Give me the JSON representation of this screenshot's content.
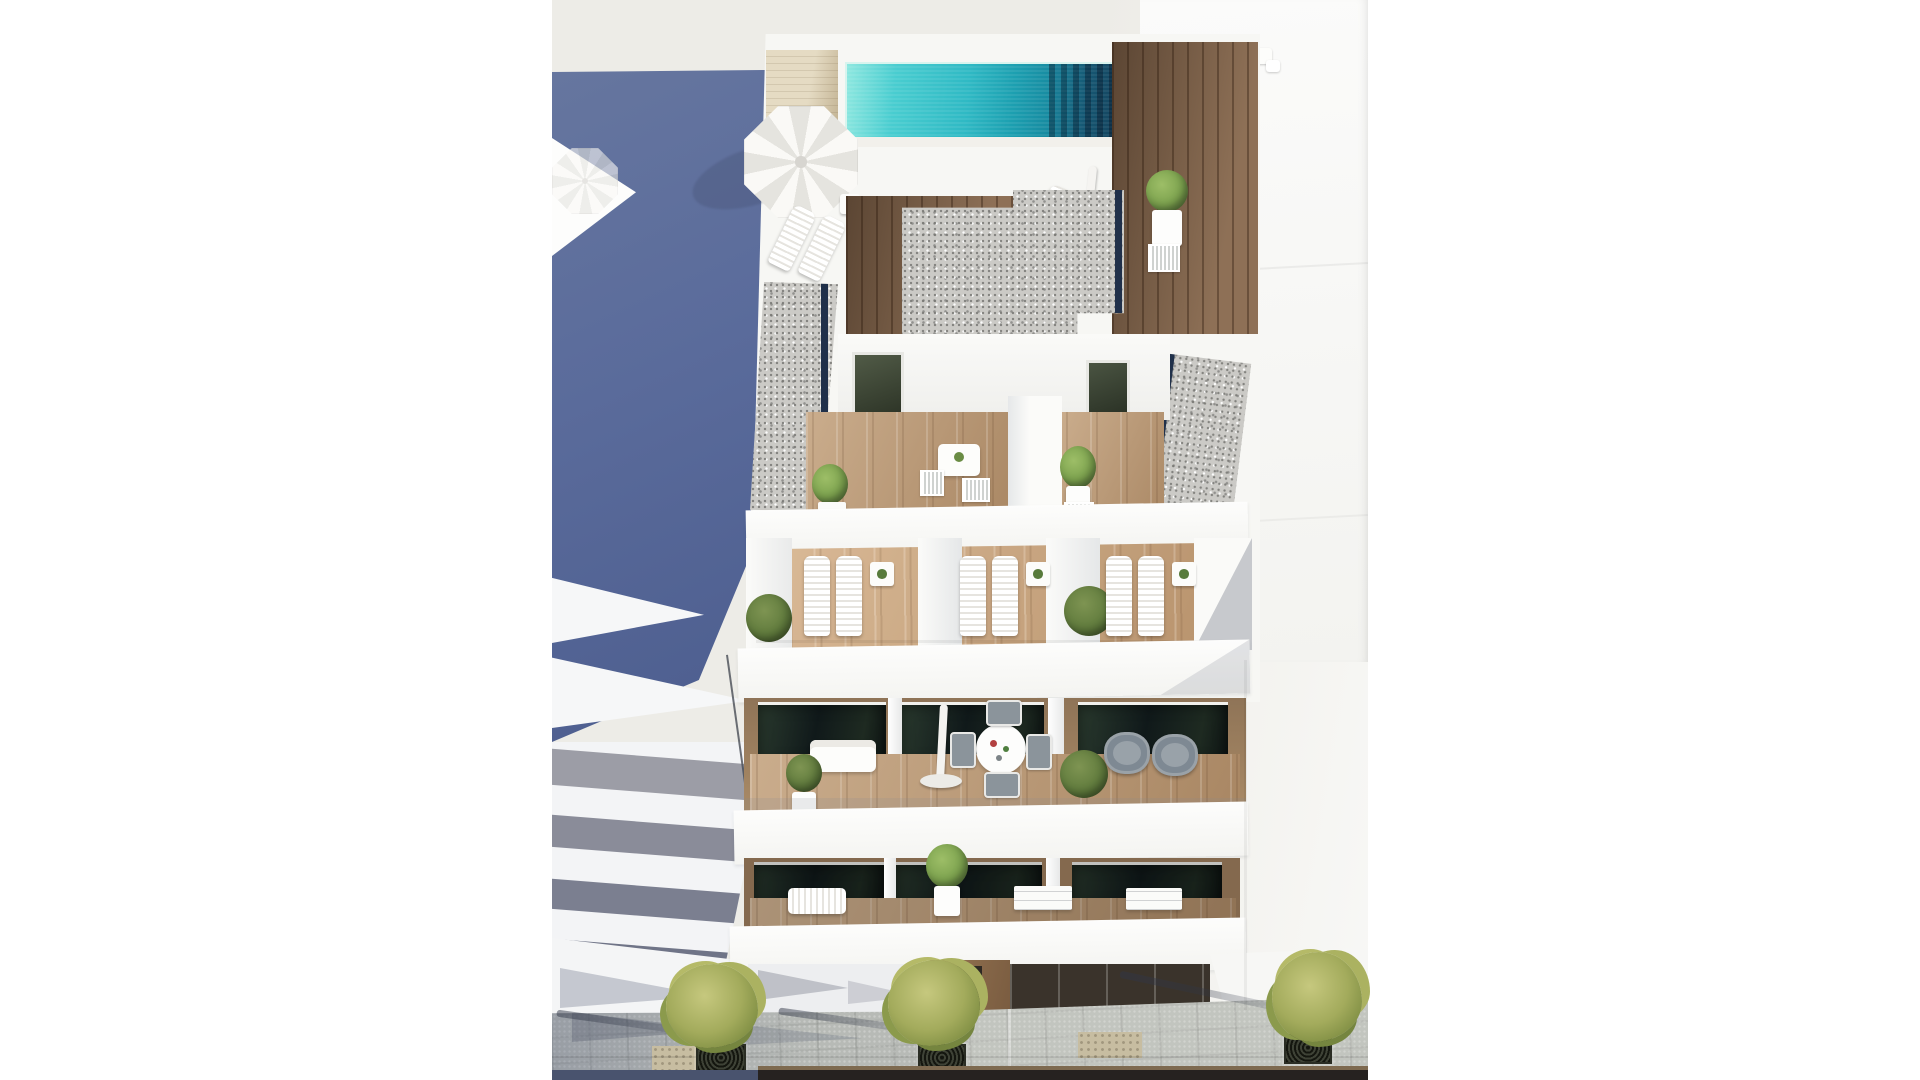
{
  "image": {
    "width": 1920,
    "height": 1080
  },
  "scene": {
    "type": "architectural_aerial_render",
    "subject": "Aerial 3D render of a modern white apartment building with rooftop pool, terraces, balconies and street below",
    "features": [
      "rooftop pool with mosaic water",
      "sun deck with open parasol and loungers",
      "gravel flat roofs with glass edges",
      "private terraces with sun loungers and plants",
      "stacked balconies with dining set, armchairs and closed parasol",
      "neighboring white building in shadow",
      "paved sidewalk with street trees"
    ]
  },
  "palette": {
    "backdrop": "#EDECE7",
    "backdrop_right": "#F8F8F6",
    "shadow_blue": "#5A6B9B",
    "shadow_blue_deep": "#4C5D8E",
    "neighbor_band_light": "#9C9DA6",
    "neighbor_band_mid": "#8A8C99",
    "neighbor_band_dark": "#7B7F90",
    "white_wall": "#FBFBFA",
    "pool_aqua_light": "#8FE8E0",
    "pool_aqua": "#2FB9C4",
    "pool_deep": "#123F58",
    "wood_walnut": "#7E6047",
    "wood_oak": "#B6936E",
    "wood_beige": "#DCCFAF",
    "gravel": "#CBCAC6",
    "glass_dark": "#1C241E",
    "navy_edge": "#20304A",
    "plant_green": "#7CA24E",
    "plant_olive": "#5F7A3C",
    "street_tree": "#A3AB5C",
    "pavement": "#B7BAB6",
    "asphalt_blue": "#49536E",
    "asphalt_dark": "#262220",
    "curb_tan": "#7E6A50",
    "chair_gray": "#8B949B"
  },
  "building": {
    "lounger_bays": [
      {
        "x": 804
      },
      {
        "x": 960
      },
      {
        "x": 1106
      }
    ],
    "visible_floor_bands": 5,
    "balcony_glass_panels": 6
  },
  "street": {
    "trees": [
      {
        "grate": {
          "x": 696,
          "y": 1044,
          "w": 46,
          "h": 26
        },
        "canopy": {
          "x": 666,
          "y": 964,
          "w": 92,
          "h": 84
        },
        "shadow": {
          "x": 556,
          "y": 1020,
          "w": 150,
          "rot": 8
        }
      },
      {
        "grate": {
          "x": 918,
          "y": 1044,
          "w": 44,
          "h": 26
        },
        "canopy": {
          "x": 888,
          "y": 960,
          "w": 92,
          "h": 86
        },
        "shadow": {
          "x": 778,
          "y": 1018,
          "w": 152,
          "rot": 8
        }
      },
      {
        "grate": {
          "x": 1284,
          "y": 1034,
          "w": 44,
          "h": 26
        },
        "canopy": {
          "x": 1272,
          "y": 952,
          "w": 90,
          "h": 90
        },
        "shadow": {
          "x": 1118,
          "y": 990,
          "w": 186,
          "rot": 12
        }
      }
    ]
  }
}
